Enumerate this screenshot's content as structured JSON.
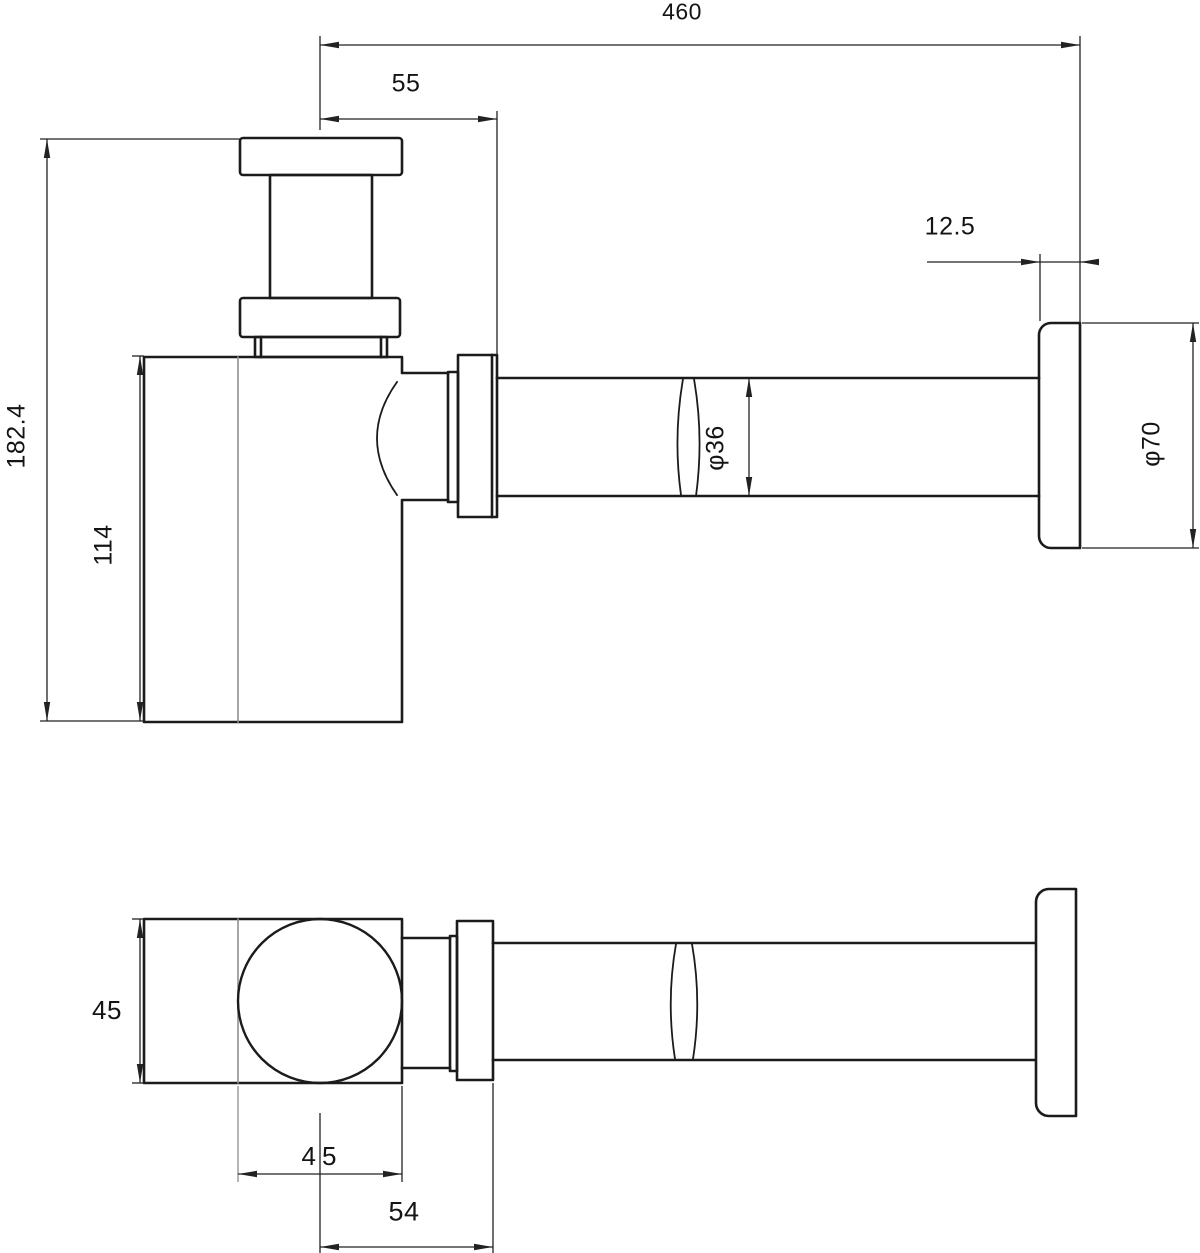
{
  "drawing": {
    "background": "#ffffff",
    "line_color": "#1b1b1b",
    "dimension_color": "#222222",
    "seam_color": "#8f8f8f",
    "description": "bottle-trap-technical-drawing",
    "side_view": {
      "dimensions": {
        "overall_length": "460",
        "centre_to_nut": "55",
        "flange_depth": "12.5",
        "overall_height": "182.4",
        "body_height": "114",
        "pipe_diameter": "φ36",
        "flange_diameter": "φ70"
      }
    },
    "plan_view": {
      "dimensions": {
        "body_depth": "45",
        "body_width": "45",
        "centre_to_nut": "54"
      }
    }
  }
}
